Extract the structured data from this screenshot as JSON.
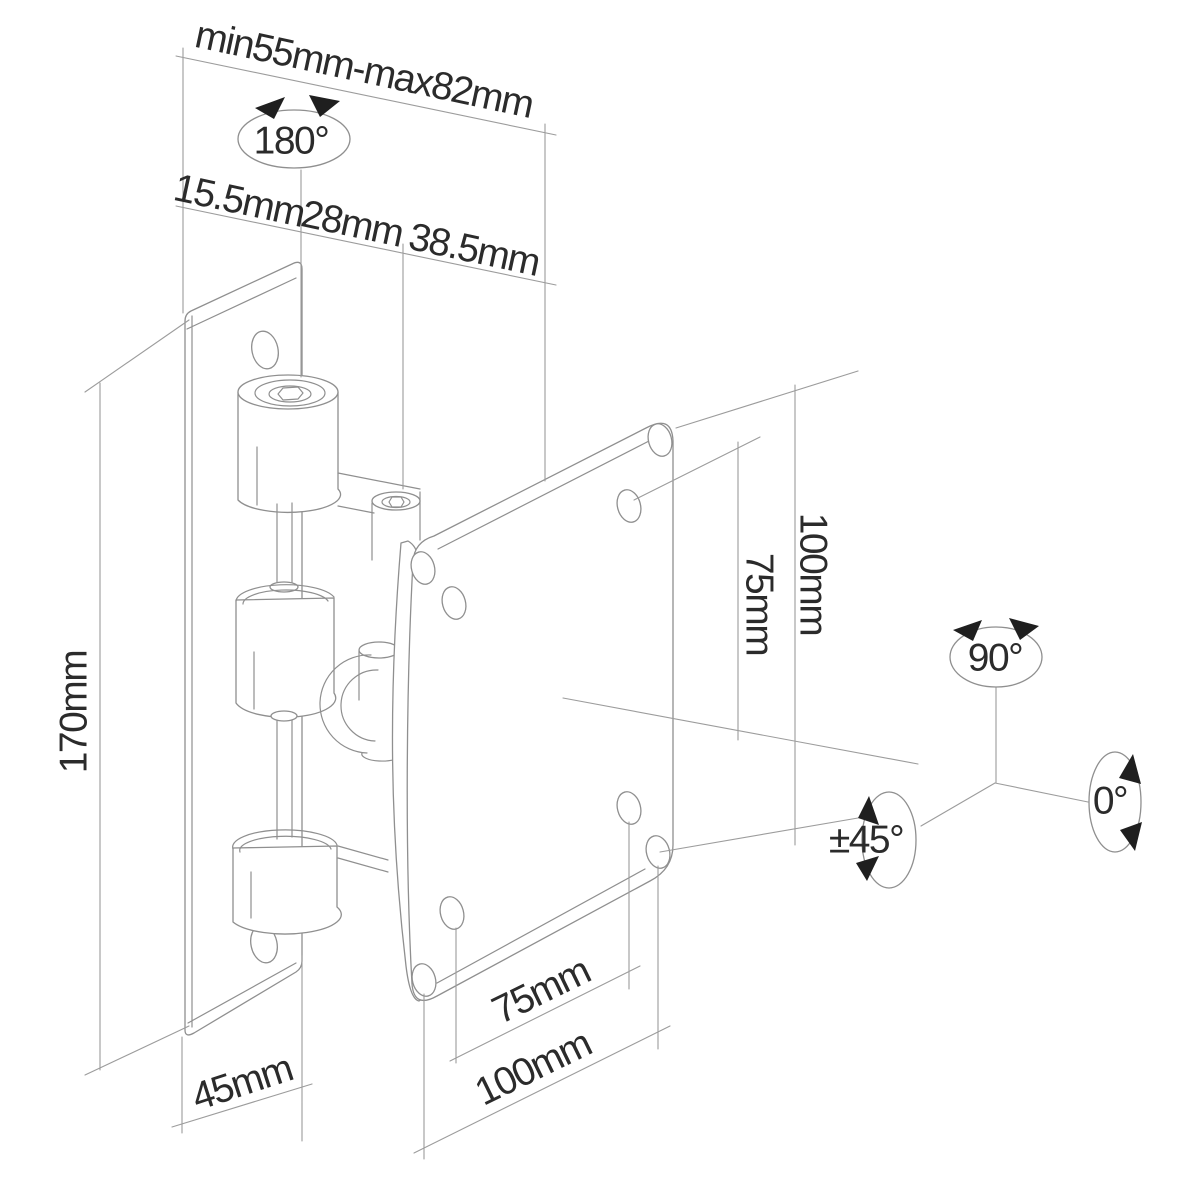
{
  "dimensions": {
    "top_span": "min55mm-max82mm",
    "top_segments": [
      "15.5mm",
      "28mm",
      "38.5mm"
    ],
    "left_height": "170mm",
    "right": {
      "outer_vertical": "100mm",
      "inner_vertical": "75mm"
    },
    "bottom": {
      "depth": "45mm",
      "inner_width": "75mm",
      "outer_width": "100mm"
    }
  },
  "angles": {
    "pan": "180°",
    "up": "90°",
    "neutral": "0°",
    "tilt": "±45°"
  },
  "colors": {
    "background": "#ffffff",
    "part_line": "#8f8f8f",
    "dimension_line": "#9c9c9c",
    "label_text": "#2b2b2b",
    "arrowhead": "#1f1f1f"
  }
}
